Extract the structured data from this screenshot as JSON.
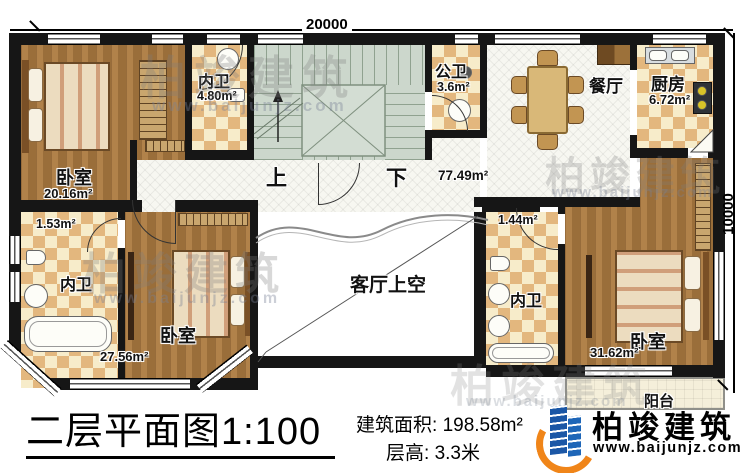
{
  "dimensions": {
    "top": "20000",
    "right": "10000"
  },
  "rooms": {
    "bedroom_tl": {
      "name": "卧室",
      "area": "20.16m²"
    },
    "bath_tl": {
      "name": "内卫",
      "area": "4.80m²"
    },
    "stairs": {
      "up": "上",
      "down": "下"
    },
    "hall": {
      "area": "77.49m²"
    },
    "public_bath": {
      "name": "公卫",
      "area": "3.6m²"
    },
    "dining": {
      "name": "餐厅"
    },
    "kitchen": {
      "name": "厨房",
      "area": "6.72m²"
    },
    "bath_ml": {
      "name": "内卫",
      "area": "1.53m²"
    },
    "bedroom_bl": {
      "name": "卧室",
      "area": "27.56m²"
    },
    "void": {
      "name": "客厅上空"
    },
    "bath_br": {
      "name": "内卫",
      "area": "1.44m²"
    },
    "bedroom_br": {
      "name": "卧室",
      "area": "31.62m²"
    },
    "balcony": {
      "name": "阳台"
    }
  },
  "footer": {
    "title": "二层平面图1:100",
    "area_label": "建筑面积:",
    "area_value": "198.58m²",
    "floor_height_label": "层高:",
    "floor_height_value": "3.3米",
    "brand": "柏竣建筑",
    "website": "www.baijunjz.com"
  },
  "watermark": {
    "brand": "柏竣建筑",
    "website": "www.baijunjz.com"
  },
  "colors": {
    "wall": "#161616",
    "wood": "#a6763e",
    "checker_light": "#f7ecca",
    "checker_dark": "#e3b77e",
    "stairs": "#ccd7cc",
    "tile": "#f7f7f1",
    "brand_blue": "#1b57a6",
    "brand_orange": "#f08519"
  }
}
